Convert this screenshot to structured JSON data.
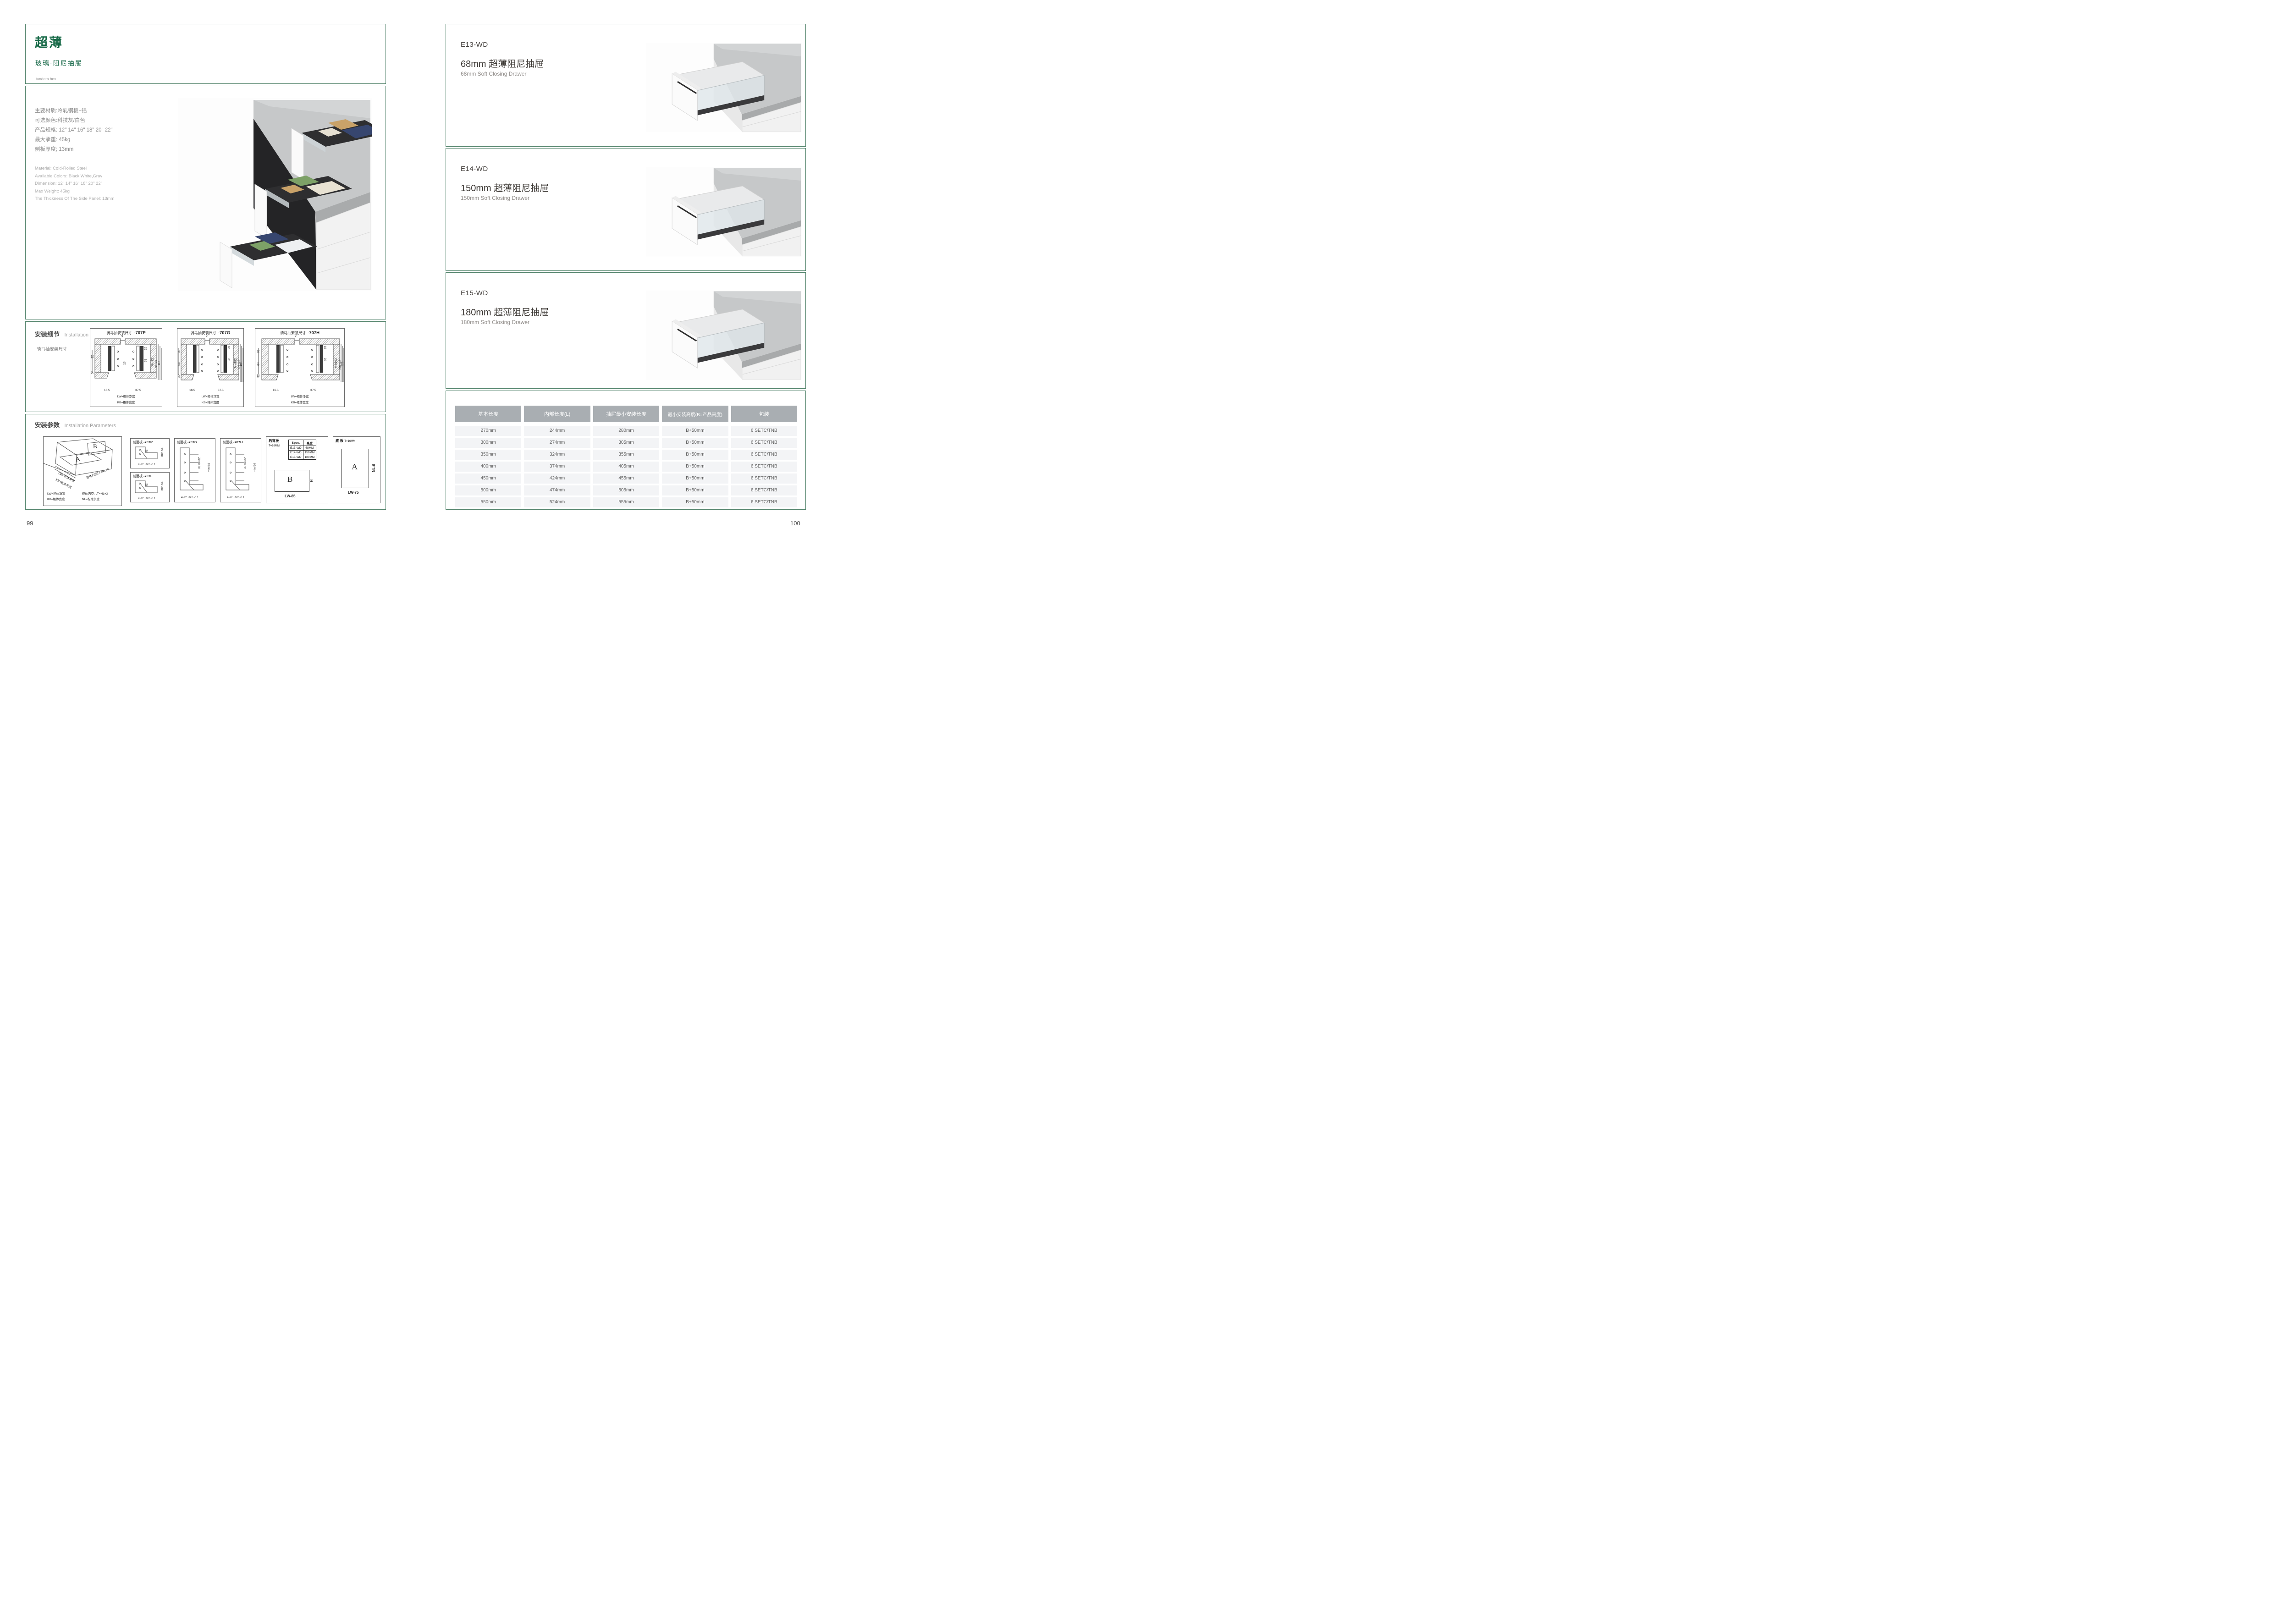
{
  "colors": {
    "accent_green": "#176947",
    "border_green": "#53846c",
    "table_header_bg": "#a9aeb2",
    "row_bg": "#f3f4f6"
  },
  "page_left": {
    "page_number": "99",
    "header": {
      "title": "超薄",
      "subtitle": "玻璃·阻尼抽屉",
      "tagline": "tandem box"
    },
    "specs_cn": [
      "主要材质:冷轧钢板+铝",
      "可选颜色:科技灰/白色",
      "产品规格: 12\" 14\" 16\" 18\" 20\" 22\"",
      "最大承重: 45kg",
      "侧板厚度; 13mm"
    ],
    "specs_en": [
      "Material: Cold-Rolled Steel",
      "Available Colors: Black,White,Gray",
      "Dimension: 12\" 14\" 16\" 18\" 20\" 22\"",
      "Max Weight: 45kg",
      "The Thickness Of The Side Panel: 13mm"
    ],
    "installation_details": {
      "title_cn": "安装细节",
      "title_en": "Installation Details",
      "subtitle": "骑马抽安装尺寸",
      "drawings": [
        {
          "title": "骑马抽安装尺寸",
          "code": "-707P",
          "dims": {
            "top": "9",
            "hole": "20",
            "pitch": "32",
            "left1": "32",
            "left2": "54",
            "mid": "16",
            "r1": "Min82",
            "r2": "91.50",
            "r3": "113",
            "b1": "16.5",
            "b2": "37.5",
            "lw": "LW=柜体净宽",
            "kb": "KB=柜体宽度"
          }
        },
        {
          "title": "骑马抽安装尺寸",
          "code": "-707G",
          "dims": {
            "top": "9",
            "hole": "20",
            "pitch": "32",
            "left1": "32",
            "left2": "64",
            "left3": "32",
            "mid": "5.4",
            "r1": "Min162",
            "r2": "171.50",
            "r3": "195",
            "b1": "16.5",
            "b2": "37.5",
            "lw": "LW=柜体净宽",
            "kb": "KB=柜体宽度"
          }
        },
        {
          "title": "骑马抽安装尺寸",
          "code": "-707H",
          "dims": {
            "top": "9",
            "hole": "20",
            "pitch": "32",
            "left1": "32",
            "left2": "64",
            "left3": "32",
            "mid": "5.4",
            "r1": "Min192",
            "r2": "201.50",
            "r3": "225",
            "b1": "16.5",
            "b2": "37.5",
            "lw": "LW=柜体净宽",
            "kb": "KB=柜体宽度"
          }
        }
      ]
    },
    "installation_parameters": {
      "title_cn": "安装参数",
      "title_en": "Installation Parameters",
      "cabinet": {
        "label_a": "A",
        "label_b": "B",
        "lw": "LW=柜体净宽",
        "kb": "KB=柜体宽度",
        "lt": "柜体内空LT=NL+3",
        "legend": {
          "l1": "LW=柜体净宽",
          "l2": "柜体内空: LT=NL+3",
          "l3": "KB=柜体宽度",
          "l4": "NL=标准长度"
        }
      },
      "panels": [
        {
          "title": "前面板",
          "code": "-707P",
          "dim_side": "32",
          "dim_min": "min 54",
          "hole": "2-ø2 +0.2 -0.1"
        },
        {
          "title": "前面板",
          "code": "-707L",
          "dim_side": "32",
          "dim_min": "min 54",
          "hole": "2-ø2 +0.2 -0.1"
        },
        {
          "title": "前面板",
          "code": "-707G",
          "dim_side": "32 64 32",
          "dim_min": "min 54",
          "hole": "4-ø2 +0.2 -0.1"
        },
        {
          "title": "前面板",
          "code": "-707H",
          "dim_side": "32 64 32",
          "dim_min": "min 54",
          "hole": "4-ø2 +0.2 -0.1"
        }
      ],
      "back_panel": {
        "title": "后背板",
        "thickness": "T=16MM",
        "spec_table": {
          "headers": [
            "Spec.",
            "高度"
          ],
          "rows": [
            [
              "E13-WD",
              "68MM"
            ],
            [
              "E14-WD",
              "150MM"
            ],
            [
              "E15-WD",
              "180MM"
            ]
          ]
        },
        "label": "B",
        "h_label": "H",
        "w_label": "LW-85"
      },
      "bottom_panel": {
        "title": "底 板",
        "thickness": "T=16MM",
        "label": "A",
        "side_label": "NL-6",
        "w_label": "LW-75"
      }
    }
  },
  "page_right": {
    "page_number": "100",
    "sections": [
      {
        "model": "E13-WD",
        "title_cn": "68mm 超薄阻尼抽屉",
        "title_en": "68mm Soft Closing Drawer"
      },
      {
        "model": "E14-WD",
        "title_cn": "150mm 超薄阻尼抽屉",
        "title_en": "150mm Soft Closing Drawer"
      },
      {
        "model": "E15-WD",
        "title_cn": "180mm 超薄阻尼抽屉",
        "title_en": "180mm Soft Closing Drawer"
      }
    ],
    "table": {
      "headers": [
        "基本长度",
        "内部长度(L)",
        "抽屉最小安装长度",
        "最小安装高度(B=产品高度)",
        "包装"
      ],
      "rows": [
        [
          "270mm",
          "244mm",
          "280mm",
          "B+50mm",
          "6 SETC/TNB"
        ],
        [
          "300mm",
          "274mm",
          "305mm",
          "B+50mm",
          "6 SETC/TNB"
        ],
        [
          "350mm",
          "324mm",
          "355mm",
          "B+50mm",
          "6 SETC/TNB"
        ],
        [
          "400mm",
          "374mm",
          "405mm",
          "B+50mm",
          "6 SETC/TNB"
        ],
        [
          "450mm",
          "424mm",
          "455mm",
          "B+50mm",
          "6 SETC/TNB"
        ],
        [
          "500mm",
          "474mm",
          "505mm",
          "B+50mm",
          "6 SETC/TNB"
        ],
        [
          "550mm",
          "524mm",
          "555mm",
          "B+50mm",
          "6 SETC/TNB"
        ]
      ]
    }
  }
}
